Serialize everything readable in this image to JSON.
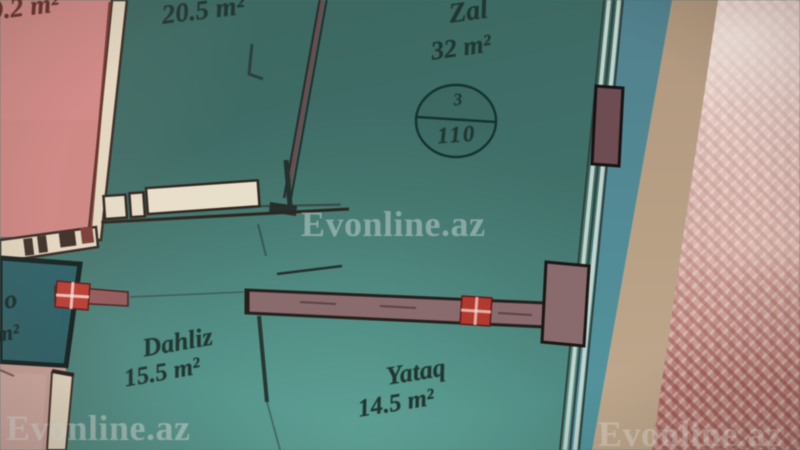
{
  "watermark": {
    "text": "Evonline.az"
  },
  "rooms": {
    "top_left": {
      "area": "9.2 m²"
    },
    "top_middle": {
      "area": "20.5 m²"
    },
    "zal": {
      "name": "Zal",
      "area": "32 m²"
    },
    "dahliz": {
      "name": "Dahliz",
      "area": "15.5 m²"
    },
    "yataq": {
      "name": "Yataq",
      "area": "14.5 m²"
    },
    "bottom_left_partial": {
      "line1": "o",
      "line2": "m²"
    }
  },
  "unit_badge": {
    "room_count": "3",
    "apartment_number": "110"
  },
  "colors": {
    "plan_teal": "#3e716a",
    "pink_room": "#d28582",
    "bath_teal": "#266067",
    "wall_cream": "#e7dac3",
    "wall_mauve": "#8b696c",
    "marker_red": "#bf3a30",
    "paper_blue_edge": "#4e818e",
    "table_beige": "#bba084",
    "carpet_pink": "#c5918a",
    "ink": "#1c342e"
  }
}
